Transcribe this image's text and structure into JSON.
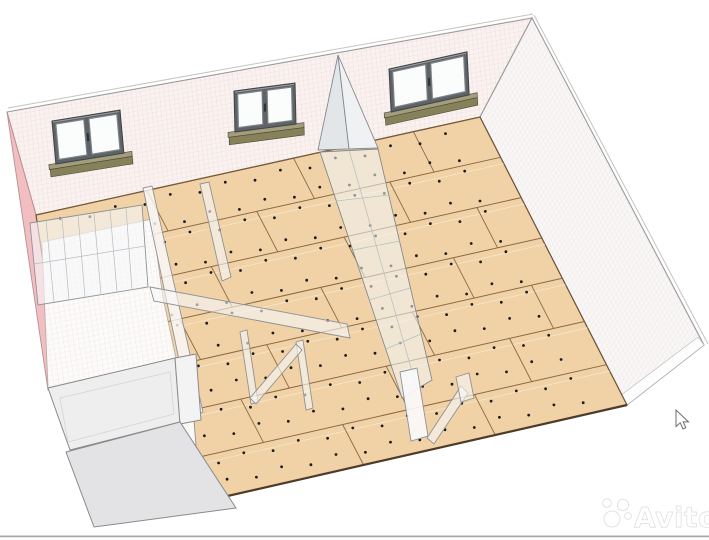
{
  "app": {
    "name": "3d-construction-floor-model-view"
  },
  "watermark": {
    "text": "Avito"
  },
  "colors": {
    "background": "#ffffff",
    "osb_panel": "#f0d2a6",
    "osb_seam": "#8a6a45",
    "osb_bevel": "#f7e7ca",
    "osb_edge": "#5f4a33",
    "screw_dot": "#1c1c1c",
    "wall_grid_pink_bg": "#faf2f0",
    "wall_grid_pink_line": "#e9d3cf",
    "wall_grid_white_bg": "#f9f6f6",
    "wall_grid_white_line": "#e7dedd",
    "subfloor_bg": "#fcfbfa",
    "subfloor_line": "#e9e0dc",
    "insulation_pink": "#f2bec2",
    "partition_fill": "rgba(246,248,250,0.6)",
    "partition_stroke": "#8f9296",
    "window_frame": "#5d6367",
    "window_glass": "#fbfcfc",
    "sill_top": "#a39d7c",
    "sill_front": "#868159",
    "front_wall_gray": "#ededee",
    "border_line": "#a8a8a8"
  },
  "floor": {
    "quad": {
      "p00": [
        36,
        215
      ],
      "p10": [
        480,
        117
      ],
      "p01": [
        188,
        505
      ],
      "p11": [
        627,
        405
      ]
    },
    "row_ts": [
      0.14,
      0.28,
      0.42,
      0.56,
      0.71,
      0.86
    ],
    "dot_row_ts": [
      0.035,
      0.115,
      0.165,
      0.255,
      0.305,
      0.395,
      0.445,
      0.535,
      0.585,
      0.655,
      0.735,
      0.805,
      0.885,
      0.955
    ],
    "dot_u_step": 0.062,
    "joints": [
      [
        0.25,
        0.0,
        0.14
      ],
      [
        0.58,
        0.0,
        0.14
      ],
      [
        0.85,
        0.0,
        0.14
      ],
      [
        0.12,
        0.14,
        0.28
      ],
      [
        0.45,
        0.14,
        0.28
      ],
      [
        0.75,
        0.14,
        0.28
      ],
      [
        0.3,
        0.28,
        0.42
      ],
      [
        0.6,
        0.28,
        0.42
      ],
      [
        0.9,
        0.28,
        0.42
      ],
      [
        0.18,
        0.42,
        0.56
      ],
      [
        0.5,
        0.42,
        0.56
      ],
      [
        0.8,
        0.42,
        0.56
      ],
      [
        0.33,
        0.56,
        0.71
      ],
      [
        0.66,
        0.56,
        0.71
      ],
      [
        0.93,
        0.56,
        0.71
      ],
      [
        0.22,
        0.71,
        0.86
      ],
      [
        0.55,
        0.71,
        0.86
      ],
      [
        0.83,
        0.71,
        0.86
      ],
      [
        0.4,
        0.86,
        1.0
      ],
      [
        0.7,
        0.86,
        1.0
      ]
    ]
  },
  "windows": [
    {
      "name": "window-left",
      "matrix": [
        1,
        -0.16,
        0.09,
        1,
        52,
        121
      ],
      "w": 68,
      "h": 43
    },
    {
      "name": "window-middle",
      "matrix": [
        1,
        -0.13,
        0.024,
        1,
        234,
        91
      ],
      "w": 61,
      "h": 41
    },
    {
      "name": "window-right",
      "matrix": [
        1,
        -0.22,
        0.05,
        1,
        389,
        69
      ],
      "w": 78,
      "h": 43
    }
  ],
  "cursor": {
    "x": 676,
    "y": 410
  }
}
